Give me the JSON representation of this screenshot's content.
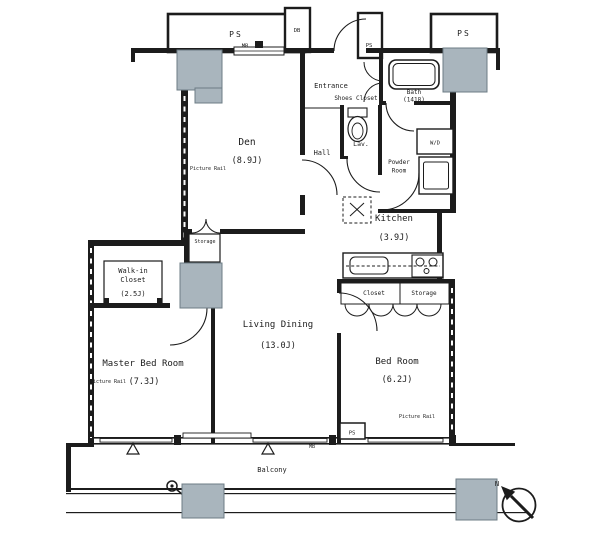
{
  "plan": {
    "rooms": {
      "den": {
        "name": "Den",
        "size": "(8.9J)"
      },
      "entrance": {
        "name": "Entrance"
      },
      "shoes_closet": {
        "name": "Shoes Closet"
      },
      "bath": {
        "name": "Bath",
        "size": "(1418)"
      },
      "lavatory": {
        "name": "Lav."
      },
      "hall": {
        "name": "Hall"
      },
      "powder_room": {
        "line1": "Powder",
        "line2": "Room"
      },
      "kitchen": {
        "name": "Kitchen",
        "size": "(3.9J)"
      },
      "den_storage": {
        "name": "Storage"
      },
      "walk_in_closet": {
        "line1": "Walk-in",
        "line2": "Closet",
        "size": "(2.5J)"
      },
      "master_bedroom": {
        "name": "Master Bed Room",
        "size": "(7.3J)"
      },
      "living_dining": {
        "name": "Living Dining",
        "size": "(13.0J)"
      },
      "bedroom": {
        "name": "Bed Room",
        "size": "(6.2J)"
      },
      "bedroom_closet": {
        "name": "Closet"
      },
      "bedroom_storage": {
        "name": "Storage"
      },
      "balcony": {
        "name": "Balcony"
      }
    },
    "labels": {
      "pipe_space": "PS",
      "distribution_board": "DB",
      "washer_dryer": "W/D",
      "meter_box": "MB",
      "picture_rail": "Picture Rail",
      "north": "N"
    },
    "colors": {
      "line": "#1c1c1c",
      "pillar": "#a9b5bd",
      "pillar_border": "#6d7c85",
      "bg": "#ffffff"
    }
  }
}
